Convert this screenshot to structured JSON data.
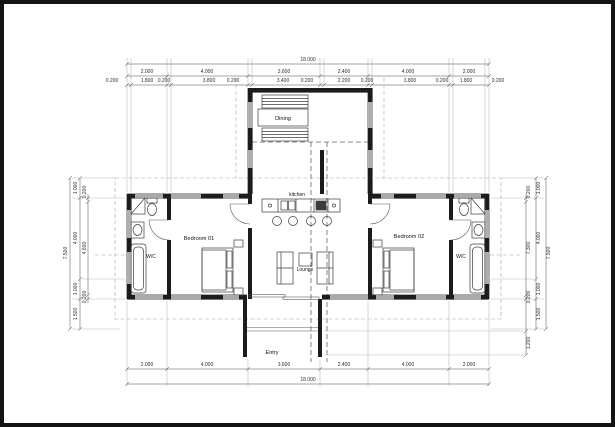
{
  "drawing": {
    "type": "architectural-floor-plan",
    "rooms": {
      "dining": "Dining",
      "kitchen": "kitchen",
      "lounge": "Lounge",
      "entry": "Entry",
      "bedroom1": "Bedroom 01",
      "bedroom2": "Bedroom 02",
      "wc_left": "W/C",
      "wc_right": "W/C"
    },
    "dims": {
      "top_overall": "18.000",
      "top_main": [
        "2.000",
        "4.000",
        "3.600",
        "2.400",
        "4.000",
        "2.000"
      ],
      "top_detail": [
        "0.200",
        "1.800",
        "0.200",
        "3.800",
        "0.200",
        "3.400",
        "0.200",
        "2.200",
        "0.200",
        "3.800",
        "0.200",
        "1.800",
        "0.200"
      ],
      "bottom_main": [
        "2.000",
        "4.000",
        "3.600",
        "2.400",
        "4.000",
        "2.000"
      ],
      "bottom_overall": "18.000",
      "left_outer": "7.500",
      "left_mid": [
        "1.000",
        "4.000",
        "1.000",
        "1.500"
      ],
      "left_inner": [
        "0.200",
        "4.600",
        "0.200"
      ],
      "right_outer": "7.500",
      "right_mid": [
        "1.000",
        "4.000",
        "1.000",
        "1.500"
      ],
      "right_inner": [
        "0.200",
        "7.300",
        "0.200"
      ],
      "entry_depth": "1.200"
    },
    "colors": {
      "wall": "#1c1c1c",
      "fixture": "#3c3c3c",
      "dim_line": "#4a4a4a",
      "extension": "#bcbcbc",
      "dash": "#8f8f8f",
      "paper": "#ffffff",
      "frame": "#141414"
    }
  }
}
